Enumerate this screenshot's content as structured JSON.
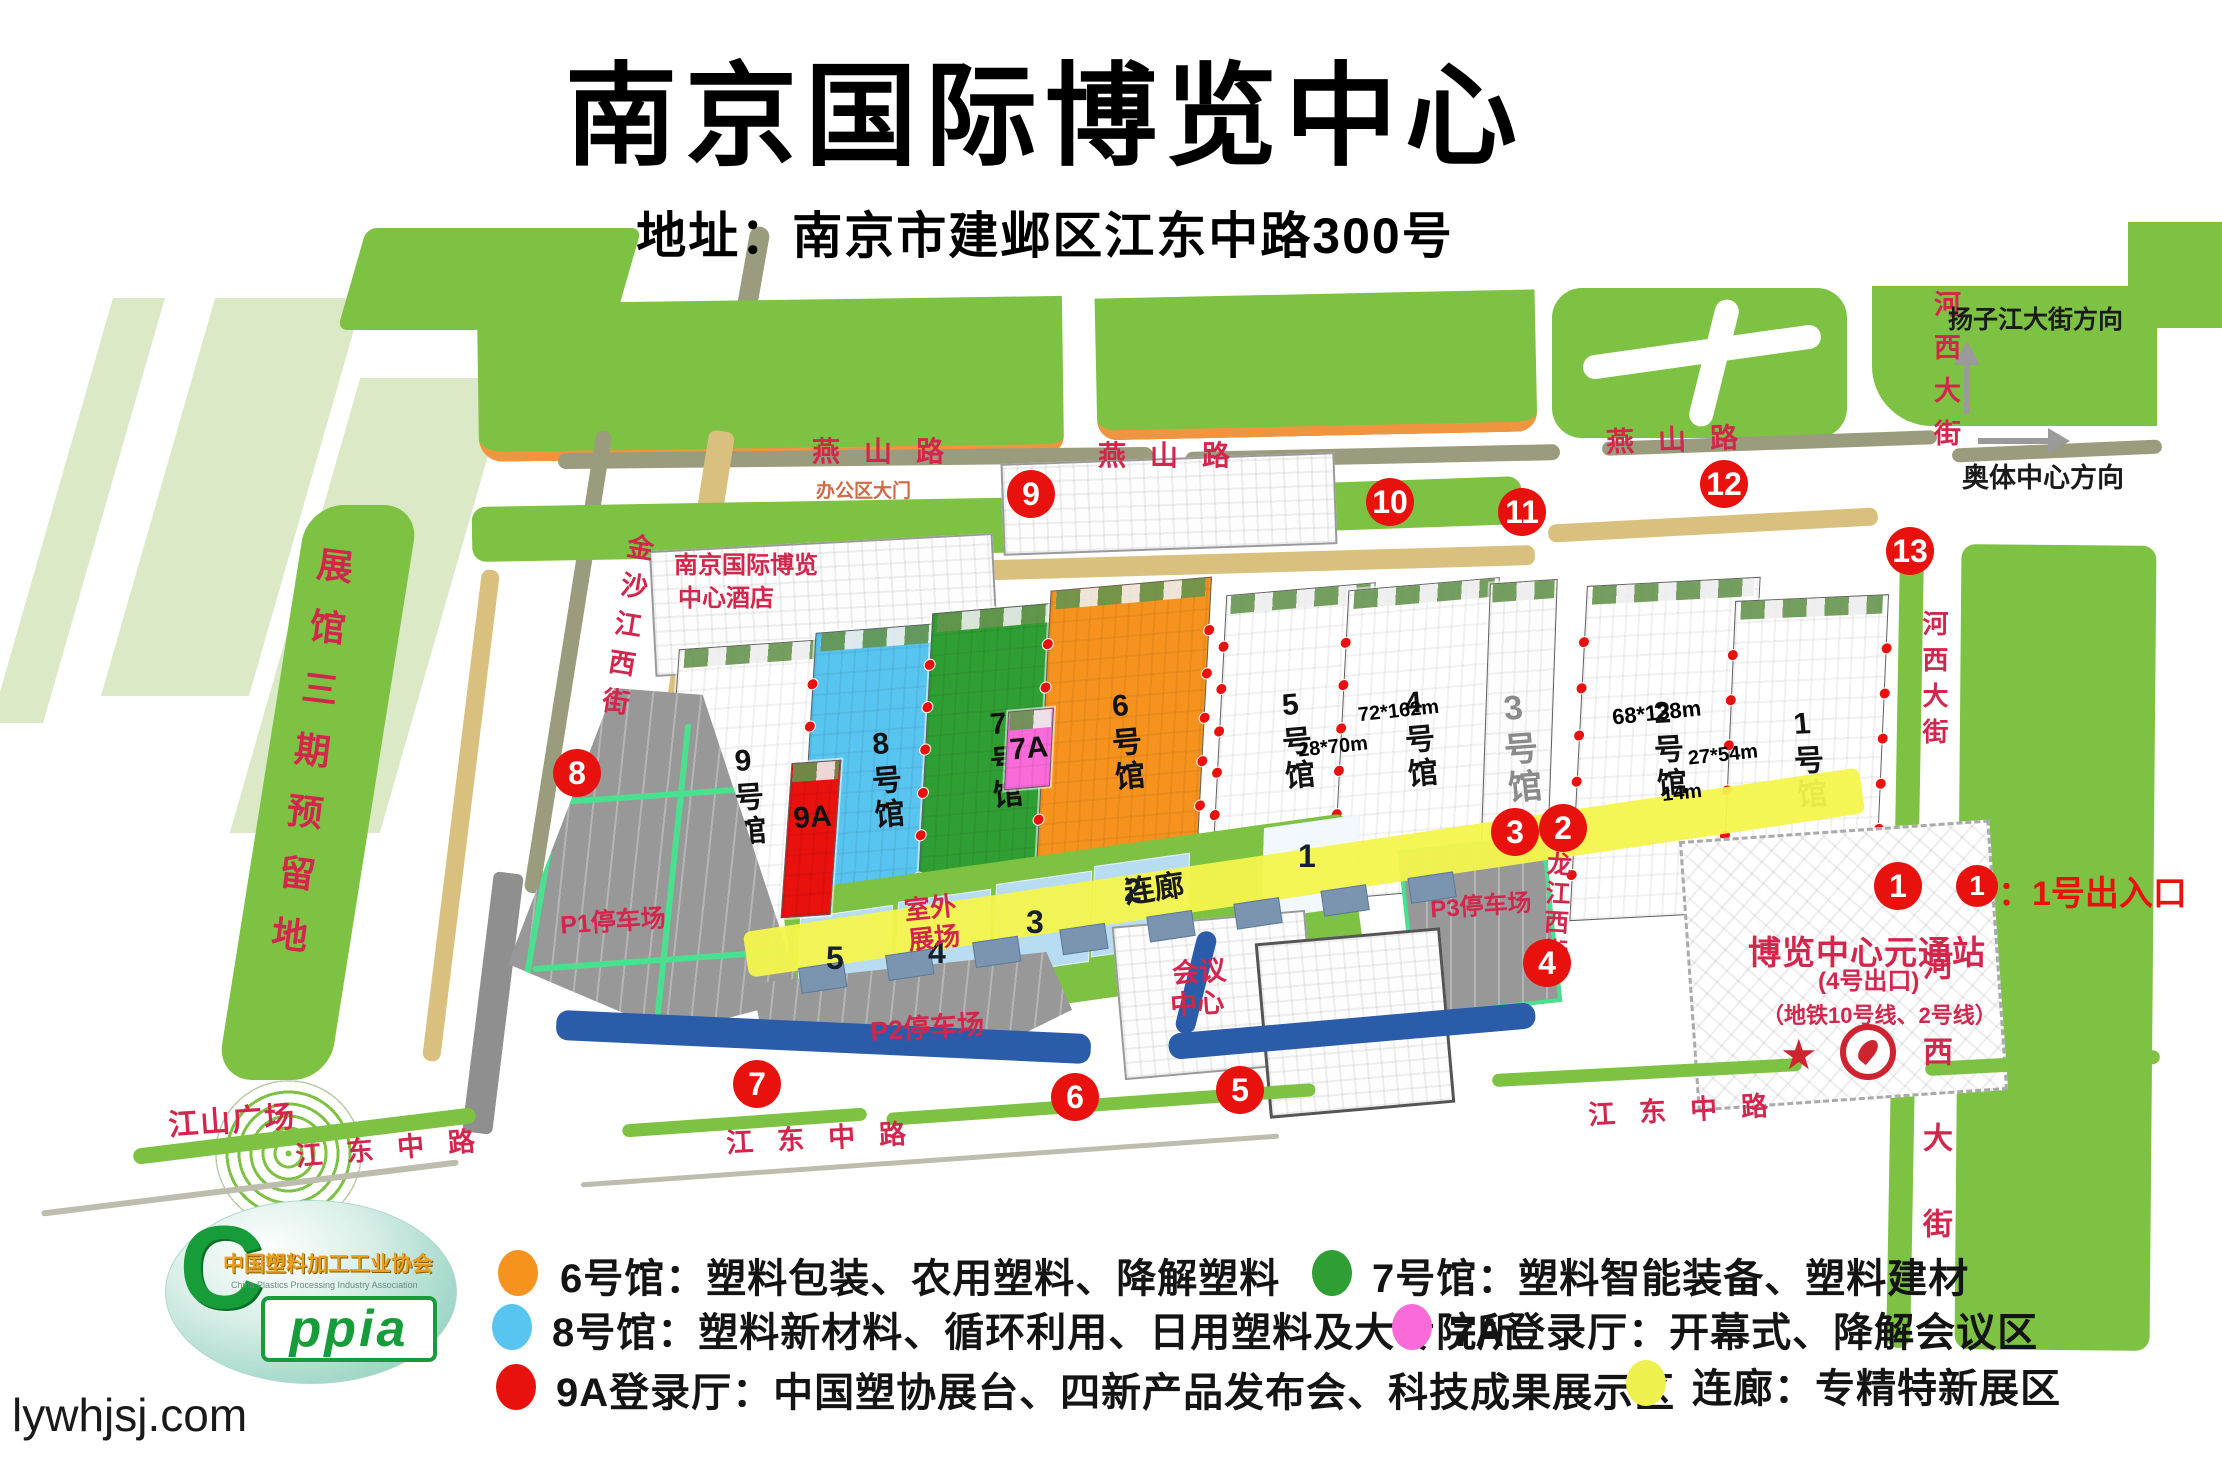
{
  "title": "南京国际博览中心",
  "subtitle": "地址：南京市建邺区江东中路300号",
  "website": "lywhjsj.com",
  "map": {
    "roads": {
      "yanshan": "燕山路",
      "jiangdong": "江东中路",
      "hexi": "河西大街",
      "jinsha": "金沙江西街",
      "bailong": "白龙江西街",
      "yangzi_dir": "扬子江大街方向",
      "aoti_dir": "奥体中心方向"
    },
    "labels": {
      "reserved": "展馆三期预留地",
      "square": "江山广场",
      "hotel1": "南京国际博览",
      "hotel2": "中心酒店",
      "office_gate": "办公区大门",
      "outdoor1": "室外",
      "outdoor2": "展场",
      "conf1": "会议",
      "conf2": "中心",
      "corridor": "连廊",
      "p1": "P1停车场",
      "p2": "P2停车场",
      "p3": "P3停车场",
      "station": "博览中心元通站",
      "station_exit": "(4号出口)",
      "station_lines": "（地铁10号线、2号线）",
      "entrance_note": "：1号出入口"
    },
    "halls": {
      "h9": "9号馆",
      "h9a": "9A",
      "h8": "8号馆",
      "h7": "7号馆",
      "h7a": "7A",
      "h6": "6号馆",
      "h5": "5号馆",
      "h4": "4号馆",
      "h3": "3号馆",
      "h2": "2号馆",
      "h1": "1号馆"
    },
    "dims": {
      "d1": "72*162m",
      "d2": "28*70m",
      "d3": "68*138m",
      "d4": "27*54m",
      "d5": "14m"
    },
    "outdoor_nums": {
      "n5": "5",
      "n4": "4",
      "n3": "3",
      "n2": "2",
      "n1": "1"
    },
    "markers": {
      "m1": "1",
      "m2": "2",
      "m3": "3",
      "m4": "4",
      "m5": "5",
      "m6": "6",
      "m7": "7",
      "m8": "8",
      "m9": "9",
      "m10": "10",
      "m11": "11",
      "m12": "12",
      "m13": "13"
    }
  },
  "legend": {
    "item1": {
      "color": "#f6921e",
      "text": "6号馆：塑料包装、农用塑料、降解塑料"
    },
    "item2": {
      "color": "#2f9e33",
      "text": "7号馆：塑料智能装备、塑料建材"
    },
    "item3": {
      "color": "#58c4f0",
      "text": "8号馆：塑料新材料、循环利用、日用塑料及大专院所"
    },
    "item4": {
      "color": "#fa6ad8",
      "text": "7A登录厅：开幕式、降解会议区"
    },
    "item5": {
      "color": "#e8110d",
      "text": "9A登录厅：中国塑协展台、四新产品发布会、科技成果展示区"
    },
    "item6": {
      "color": "#eef04e",
      "text": "连廊：专精特新展区"
    }
  },
  "logo": {
    "c": "C",
    "acronym": "ppia",
    "org_cn": "中国塑料加工工业协会",
    "org_en": "China Plastics Processing Industry Association"
  }
}
